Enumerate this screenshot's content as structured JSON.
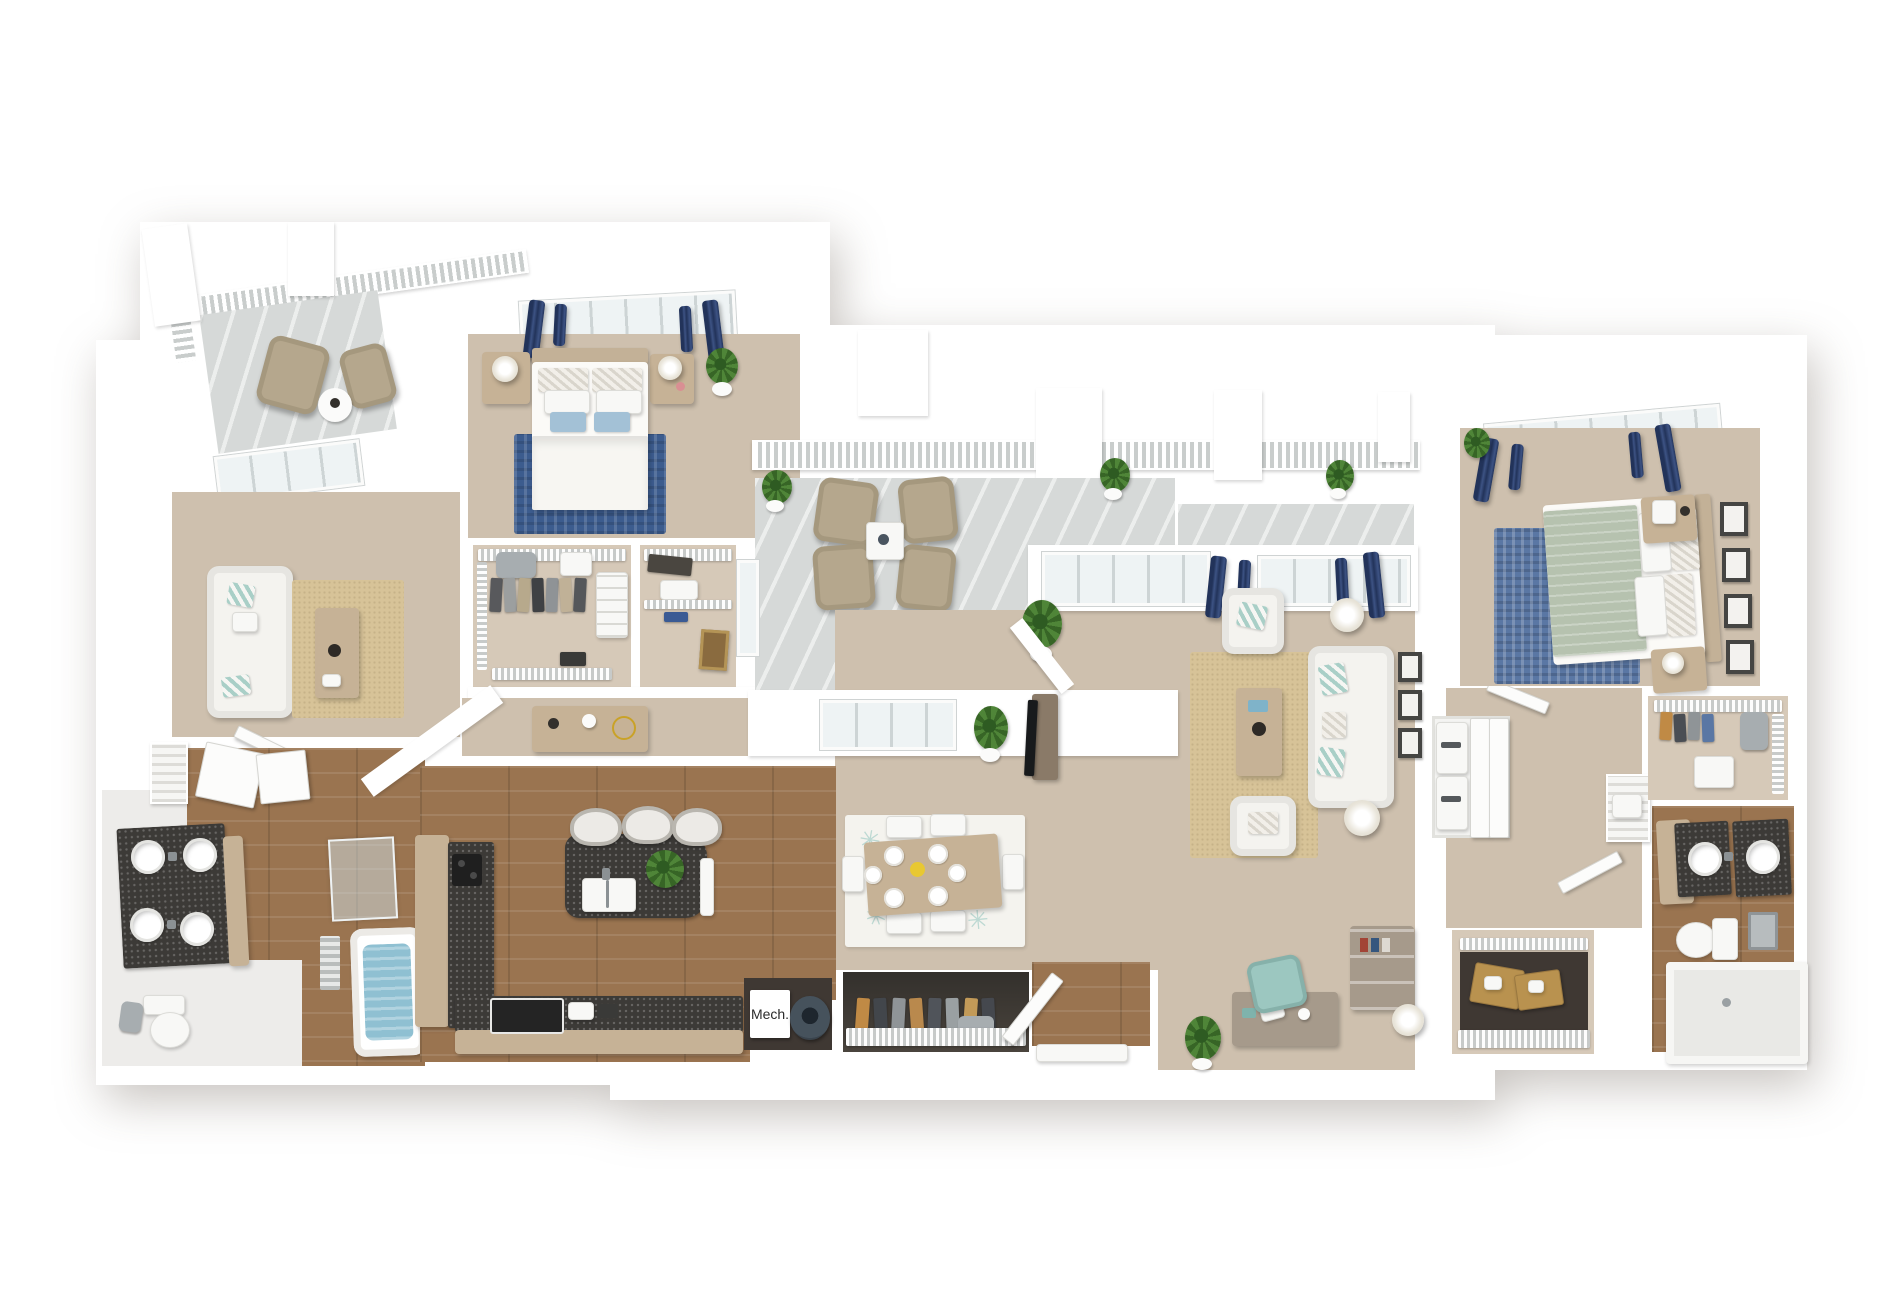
{
  "meta": {
    "scene": "3D isometric floor plan rendering of a multi-bedroom apartment, viewed top-down on a white background"
  },
  "labels": {
    "mech_room": "Mech."
  },
  "icons": {
    "rug_star": "✳"
  },
  "colors": {
    "wall": "#ffffff",
    "carpet": "#cec0ae",
    "carpetLight": "#d6c9b8",
    "wood": "#9a7450",
    "tanWood": "#c6b296",
    "granite": "#3c3a37",
    "concrete": "#d6d9d8",
    "navy": "#2c3d66",
    "teal": "#a9cfc7",
    "sofa": "#f4f3ef",
    "beige": "#b5a78d",
    "jute": "#d7c398",
    "rugBlue": "#3c5c8e",
    "denim": "#5a77a4",
    "sage": "#b6c2af",
    "plant": "#4f8538",
    "water": "#8fc0d2",
    "darkInterior": "#3f3833",
    "frame": "#454543"
  },
  "rooms": [
    {
      "id": "balcony-upper-left",
      "floor": "concrete",
      "items": [
        "railing",
        "patio chair x2",
        "side table"
      ]
    },
    {
      "id": "den",
      "floor": "carpet",
      "items": [
        "glass patio door",
        "loveseat with teal pillows",
        "jute rug",
        "coffee table",
        "louvered utility unit"
      ]
    },
    {
      "id": "bedroom-1",
      "floor": "carpet",
      "items": [
        "window with navy curtains",
        "bed with blue pillows",
        "nightstand x2 with lamps",
        "navy area rug",
        "potted plant"
      ]
    },
    {
      "id": "walk-in-closet-1",
      "floor": "carpet",
      "items": [
        "wire shelving",
        "hanging clothes",
        "suitcase",
        "shoe rack"
      ]
    },
    {
      "id": "walk-in-closet-2",
      "floor": "carpet",
      "items": [
        "wire shelving",
        "duffel bag",
        "storage bins",
        "leaning art frame"
      ]
    },
    {
      "id": "hallway",
      "floor": "carpet",
      "items": [
        "console table with decor"
      ]
    },
    {
      "id": "patio",
      "floor": "concrete",
      "items": [
        "railing",
        "columns",
        "patio chair x4",
        "coffee table",
        "potted plant x3",
        "glass door"
      ]
    },
    {
      "id": "living-room",
      "floor": "carpet",
      "items": [
        "windows with navy curtains",
        "sofa",
        "armchair x2",
        "floor lamp x2",
        "coffee table",
        "jute rug",
        "wall frames",
        "TV on console",
        "potted plant"
      ]
    },
    {
      "id": "dining-area",
      "floor": "carpet",
      "items": [
        "dining table with 6 place settings",
        "chair x6",
        "patterned rug",
        "potted plant"
      ]
    },
    {
      "id": "kitchen",
      "floor": "wood",
      "items": [
        "L-shaped granite counter",
        "island with double sink and plant",
        "bar stool x3",
        "range",
        "cooktop"
      ]
    },
    {
      "id": "mech-closet",
      "floor": "dark",
      "items": [
        "Mech. unit box",
        "water heater"
      ]
    },
    {
      "id": "coat-closet",
      "floor": "dark",
      "items": [
        "hanging clothes",
        "wire shelf",
        "suitcase"
      ]
    },
    {
      "id": "entry",
      "floor": "wood",
      "items": [
        "open entry door",
        "threshold"
      ]
    },
    {
      "id": "office-nook",
      "floor": "carpet",
      "items": [
        "desk with laptop",
        "teal desk chair",
        "bookshelf",
        "floor lamp",
        "potted plant"
      ]
    },
    {
      "id": "storage-closet",
      "floor": "carpet",
      "items": [
        "wire shelving",
        "cardboard boxes"
      ]
    },
    {
      "id": "laundry-closet",
      "floor": "wall",
      "items": [
        "stacked washer dryer",
        "double doors"
      ]
    },
    {
      "id": "hvac-closet",
      "floor": "carpet",
      "items": [
        "louvered door unit"
      ]
    },
    {
      "id": "bedroom-2",
      "floor": "carpet",
      "items": [
        "window with navy curtains",
        "bed with sage bedding",
        "nightstand x2 with lamps",
        "denim area rug",
        "wall frames x4",
        "potted plant"
      ]
    },
    {
      "id": "walk-in-closet-3",
      "floor": "carpet",
      "items": [
        "wire shelving",
        "hanging clothes",
        "dresser",
        "bin"
      ]
    },
    {
      "id": "bathroom-2",
      "floor": "wood",
      "items": [
        "double granite vanity with round sinks",
        "toilet",
        "shower"
      ]
    },
    {
      "id": "bathroom-1",
      "floor": "wood",
      "items": [
        "double granite vanity with vessel sinks",
        "toilet",
        "glass shower",
        "soaking tub",
        "bath mat",
        "linen cabinet"
      ]
    }
  ]
}
